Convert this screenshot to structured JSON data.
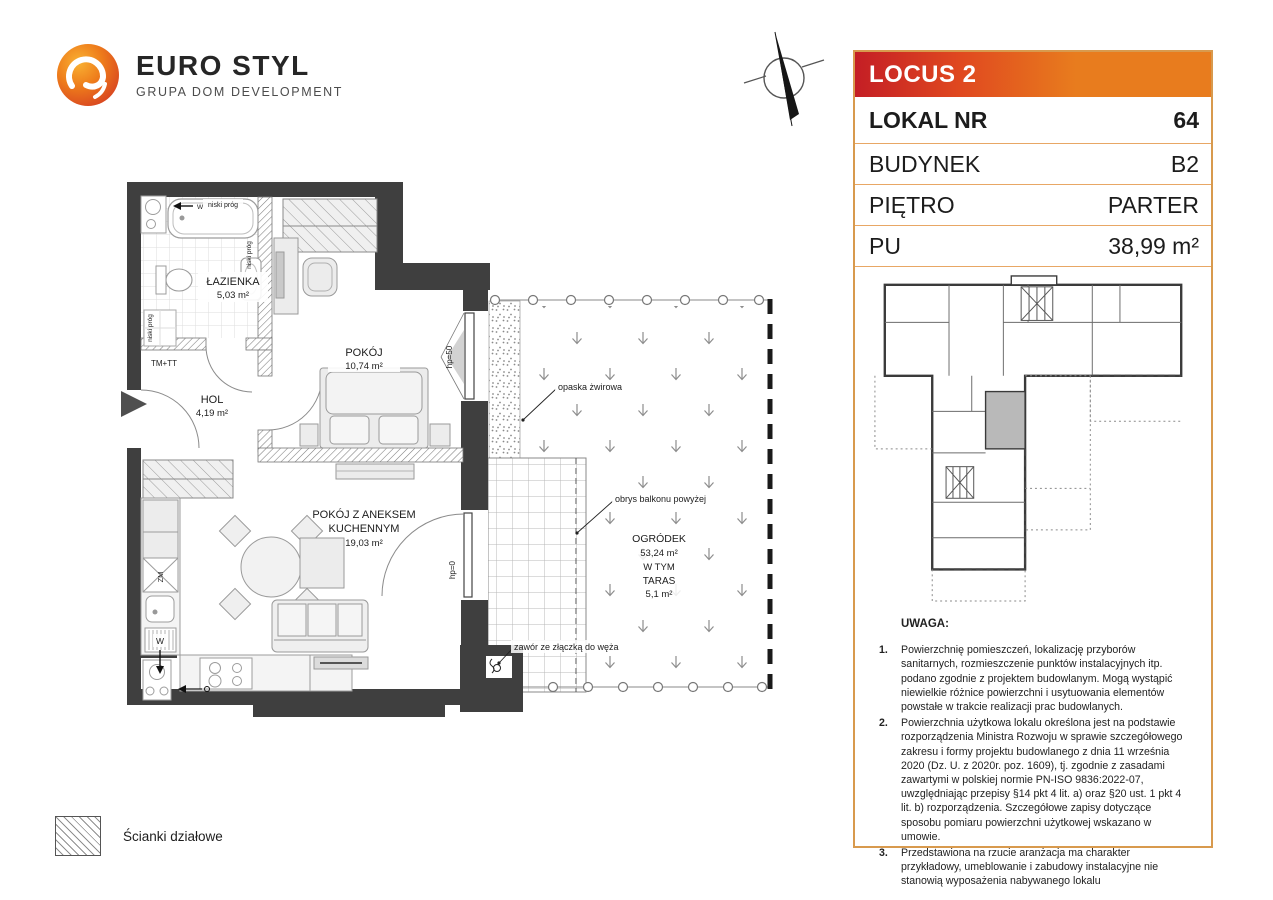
{
  "logo": {
    "brand": "EURO STYL",
    "tagline": "GRUPA DOM DEVELOPMENT"
  },
  "panel": {
    "project": "LOCUS 2",
    "rows": [
      {
        "label": "LOKAL NR",
        "value": "64"
      },
      {
        "label": "BUDYNEK",
        "value": "B2"
      },
      {
        "label": "PIĘTRO",
        "value": "PARTER"
      },
      {
        "label": "PU",
        "value": "38,99 m²"
      }
    ],
    "colors": {
      "red": "#c41e25",
      "orange": "#e87c1e",
      "border": "#d89a4e"
    }
  },
  "notes": {
    "heading": "UWAGA:",
    "items": [
      {
        "num": "1.",
        "text": "Powierzchnię pomieszczeń, lokalizację przyborów sanitarnych, rozmieszczenie punktów instalacyjnych itp. podano zgodnie z projektem budowlanym. Mogą wystąpić niewielkie różnice powierzchni i usytuowania elementów powstałe w trakcie realizacji prac budowlanych."
      },
      {
        "num": "2.",
        "text": "Powierzchnia użytkowa lokalu określona jest na podstawie rozporządzenia Ministra Rozwoju w sprawie szczegółowego zakresu i formy projektu budowlanego z dnia 11 września 2020 (Dz. U. z 2020r. poz. 1609), tj. zgodnie z zasadami zawartymi w polskiej normie PN-ISO 9836:2022-07, uwzględniając przepisy §14 pkt 4 lit. a) oraz §20 ust. 1 pkt 4 lit. b) rozporządzenia. Szczegółowe zapisy dotyczące sposobu pomiaru powierzchni użytkowej wskazano w umowie."
      },
      {
        "num": "3.",
        "text": "Przedstawiona na rzucie aranżacja ma charakter przykładowy, umeblowanie i zabudowy instalacyjne nie stanowią wyposażenia nabywanego lokalu"
      }
    ]
  },
  "plan": {
    "rooms": [
      {
        "name": "ŁAZIENKA",
        "area": "5,03 m²"
      },
      {
        "name": "POKÓJ",
        "area": "10,74 m²"
      },
      {
        "name": "HOL",
        "area": "4,19 m²"
      },
      {
        "name": "POKÓJ Z ANEKSEM",
        "name2": "KUCHENNYM",
        "area": "19,03 m²"
      }
    ],
    "garden": {
      "name": "OGRÓDEK",
      "area": "53,24 m²",
      "including": "W TYM",
      "terrace": "TARAS",
      "terrace_area": "5,1 m²"
    },
    "annotations": {
      "gravel": "opaska żwirowa",
      "balcony": "obrys balkonu powyżej",
      "valve": "zawór ze złączką do węża",
      "low_threshold": "niski próg",
      "tm_tt": "TM+TT",
      "hp50": "hp=50",
      "hp0": "hp=0",
      "zm": "ZM",
      "w": "W"
    }
  },
  "legend": {
    "partition_walls": "Ścianki działowe"
  }
}
